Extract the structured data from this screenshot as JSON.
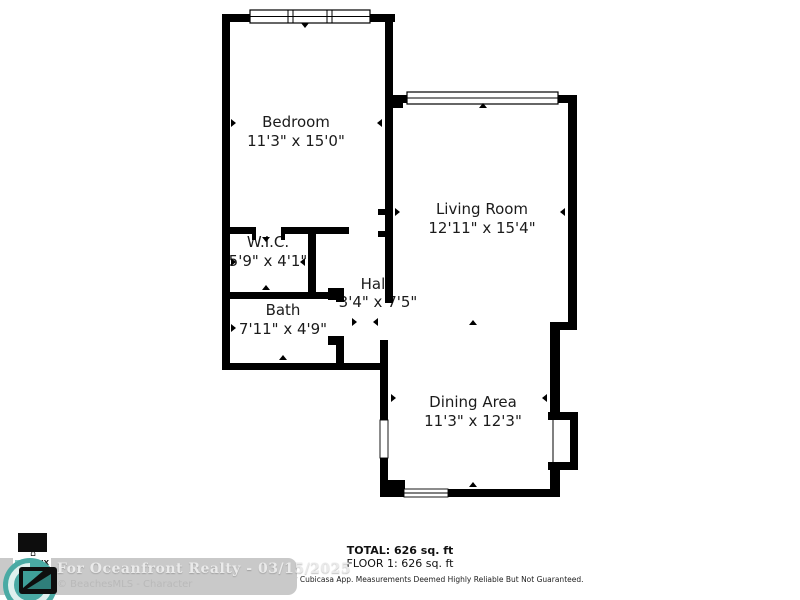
{
  "floor_plan": {
    "rooms": [
      {
        "name": "Bedroom",
        "dims": "11'3\" x 15'0\""
      },
      {
        "name": "Living Room",
        "dims": "12'11\" x 15'4\""
      },
      {
        "name": "W.I.C.",
        "dims": "5'9\" x 4'1\""
      },
      {
        "name": "Hall",
        "dims": "3'4\" x 7'5\""
      },
      {
        "name": "Bath",
        "dims": "7'11\" x 4'9\""
      },
      {
        "name": "Dining Area",
        "dims": "11'3\" x 12'3\""
      }
    ],
    "summary": {
      "total": "TOTAL: 626 sq. ft",
      "floor1": "FLOOR 1: 626 sq. ft"
    },
    "disclaimer": "Floor Plan Created By Cubicasa App. Measurements Deemed Highly Reliable But Not Guaranteed."
  },
  "watermark": {
    "line1": "For Oceanfront Realty - 03/15/2025",
    "line2": "© BeachesMLS - Character",
    "logo_text": "PIX",
    "emblem_glyph": "⌂"
  },
  "colors": {
    "wall": "#000000",
    "background": "#ffffff",
    "label": "#1b1b1b",
    "watermark_bar": "#c9c9c9",
    "watermark_text": "#eaeaea",
    "watermark_subtext": "#b9b9b9",
    "logo_teal": "#4aaaa4"
  }
}
